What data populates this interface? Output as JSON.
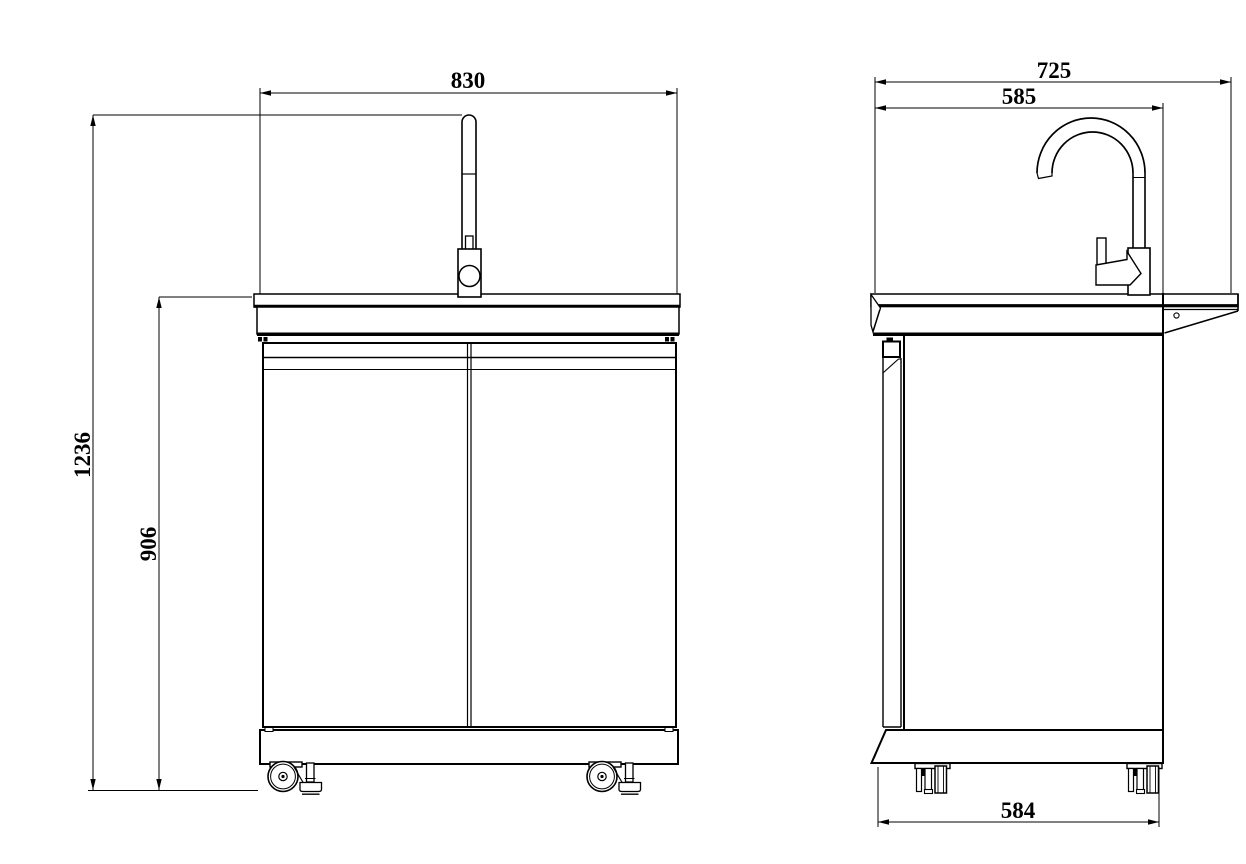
{
  "dimensions": {
    "front_width": "830",
    "overall_height": "1236",
    "bench_height": "906",
    "overall_depth": "725",
    "top_depth": "585",
    "base_depth": "584"
  },
  "colors": {
    "line": "#000000",
    "background": "#ffffff"
  }
}
